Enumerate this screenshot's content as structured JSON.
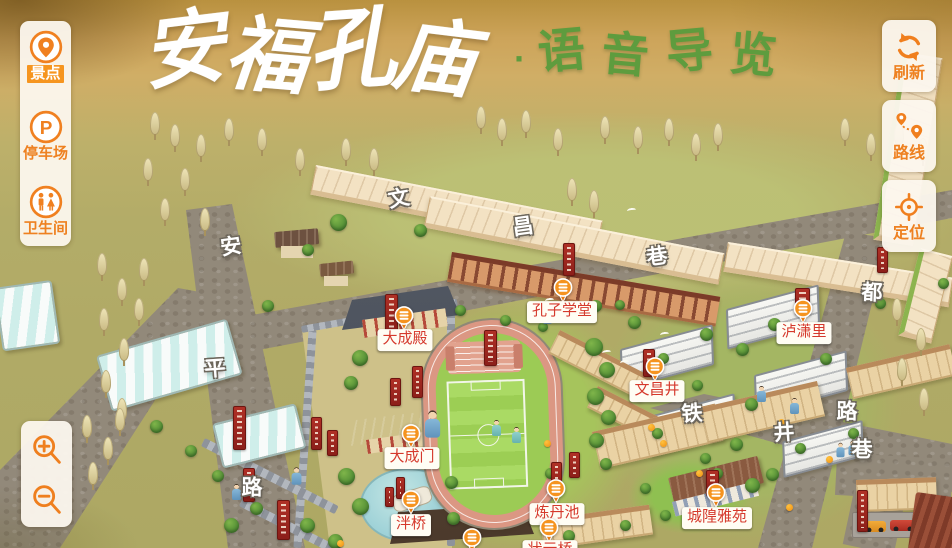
{
  "app": {
    "title_main": "安福孔庙",
    "title_separator": "·",
    "title_sub": "语音导览"
  },
  "left_toolbar": {
    "items": [
      {
        "id": "scenic-spots",
        "label": "景点",
        "icon": "scenic-pin-icon",
        "active": true
      },
      {
        "id": "parking",
        "label": "停车场",
        "icon": "parking-icon",
        "active": false
      },
      {
        "id": "restroom",
        "label": "卫生间",
        "icon": "restroom-icon",
        "active": false
      }
    ]
  },
  "right_toolbar": {
    "items": [
      {
        "id": "refresh",
        "label": "刷新",
        "icon": "refresh-icon"
      },
      {
        "id": "route",
        "label": "路线",
        "icon": "route-icon"
      },
      {
        "id": "locate",
        "label": "定位",
        "icon": "locate-icon"
      }
    ]
  },
  "zoom_controls": {
    "items": [
      {
        "id": "zoom-in",
        "icon": "zoom-in-icon"
      },
      {
        "id": "zoom-out",
        "icon": "zoom-out-icon"
      }
    ]
  },
  "map": {
    "street_characters": [
      {
        "ch": "安",
        "x": 231,
        "y": 247,
        "rot": -8
      },
      {
        "ch": "平",
        "x": 215,
        "y": 369,
        "rot": -4
      },
      {
        "ch": "路",
        "x": 252,
        "y": 488,
        "rot": 0
      },
      {
        "ch": "文",
        "x": 399,
        "y": 199,
        "rot": -10
      },
      {
        "ch": "昌",
        "x": 523,
        "y": 227,
        "rot": -8
      },
      {
        "ch": "巷",
        "x": 657,
        "y": 257,
        "rot": -8
      },
      {
        "ch": "都",
        "x": 872,
        "y": 293,
        "rot": 2
      },
      {
        "ch": "路",
        "x": 847,
        "y": 412,
        "rot": 0
      },
      {
        "ch": "巷",
        "x": 862,
        "y": 450,
        "rot": 0
      },
      {
        "ch": "铁",
        "x": 692,
        "y": 414,
        "rot": -4
      },
      {
        "ch": "井",
        "x": 784,
        "y": 433,
        "rot": -4
      }
    ],
    "pois": [
      {
        "name": "大成殿",
        "marker_x": 404,
        "marker_y": 321,
        "label_x": 405,
        "label_y": 340
      },
      {
        "name": "孔子学堂",
        "marker_x": 563,
        "marker_y": 293,
        "label_x": 562,
        "label_y": 312
      },
      {
        "name": "泸潇里",
        "marker_x": 803,
        "marker_y": 314,
        "label_x": 804,
        "label_y": 333
      },
      {
        "name": "文昌井",
        "marker_x": 655,
        "marker_y": 372,
        "label_x": 657,
        "label_y": 391
      },
      {
        "name": "大成门",
        "marker_x": 411,
        "marker_y": 439,
        "label_x": 412,
        "label_y": 458
      },
      {
        "name": "泮桥",
        "marker_x": 411,
        "marker_y": 505,
        "label_x": 411,
        "label_y": 525
      },
      {
        "name": "炼丹池",
        "marker_x": 556,
        "marker_y": 494,
        "label_x": 557,
        "label_y": 514
      },
      {
        "name": "城隍雅苑",
        "marker_x": 716,
        "marker_y": 498,
        "label_x": 717,
        "label_y": 518
      },
      {
        "name": "状元桥",
        "marker_x": 549,
        "marker_y": 533,
        "label_x": 550,
        "label_y": 551
      },
      {
        "name": "",
        "marker_x": 472,
        "marker_y": 543,
        "label_x": 0,
        "label_y": 0
      }
    ]
  },
  "colors": {
    "accent_orange": "#ef8220",
    "poi_label_red": "#d5392c",
    "title_green": "#5e9c3e",
    "banner_red": "#9e2420"
  }
}
